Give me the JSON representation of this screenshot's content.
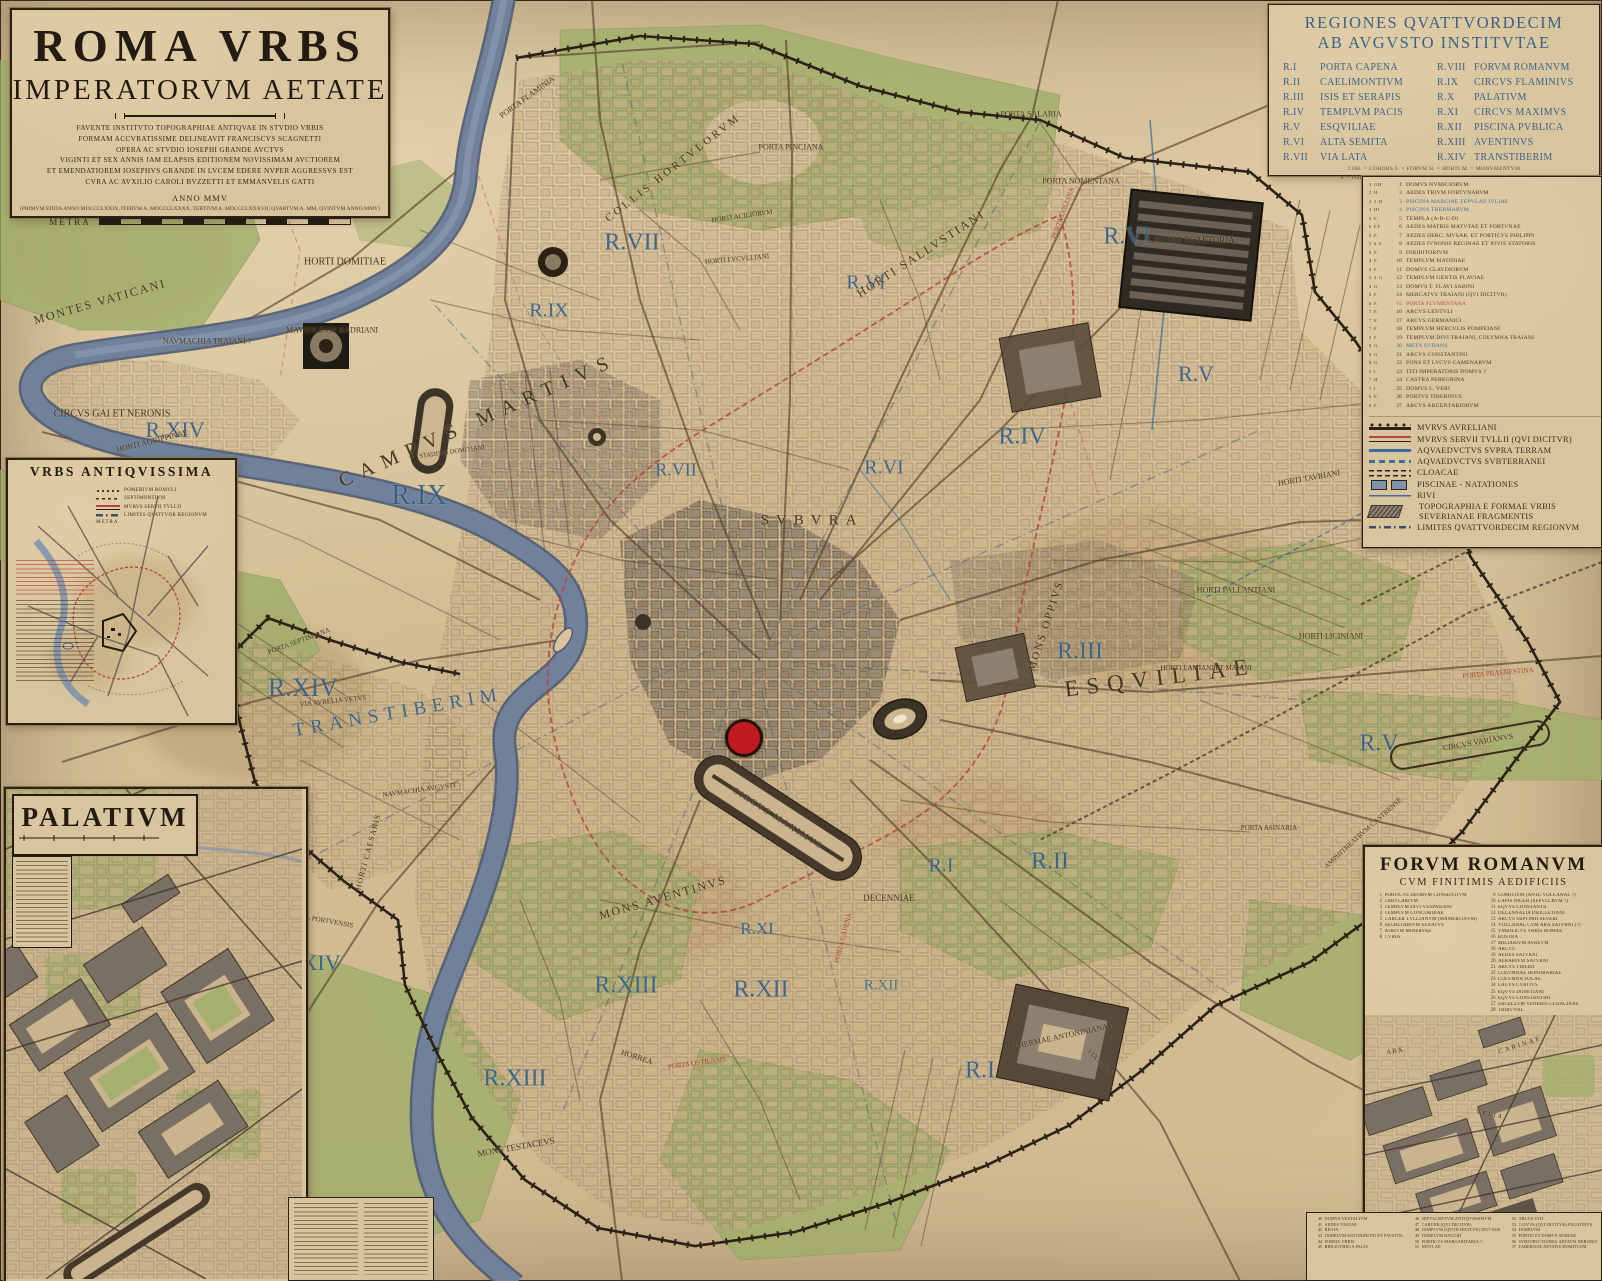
{
  "colors": {
    "accent_blue": "#33608c",
    "accent_red": "#a8372e",
    "parchment": "#d5c199",
    "river": "#71819b",
    "green": "#9fae6a",
    "wall": "#2b2115",
    "marker": "#bf1a20"
  },
  "title_panel": {
    "title1": "ROMA VRBS",
    "title2": "IMPERATORVM AETATE",
    "dedication": [
      "FAVENTE INSTITVTO TOPOGRAPHIAE ANTIQVAE IN STVDIO VRBIS",
      "FORMAM ACCVRATISSIME DELINEAVIT FRANCISCVS SCAGNETTI",
      "OPERA AC STVDIO IOSEPHI GRANDE AVCTVS",
      "VIGINTI ET SEX ANNIS IAM ELAPSIS EDITIONEM NOVISSIMAM AVCTIOREM",
      "ET EMENDATIOREM IOSEPHVS GRANDE IN LVCEM EDERE NVPER AGGRESSVS EST",
      "CVRA AC AVXILIO CAROLI BVZZETTI ET EMMANVELIS GATTI"
    ],
    "anno": "ANNO MMV",
    "editions": "(PRIMVM EDITA ANNO MDCCCLXXIX, ITERVM A. MDCCCLXXXX, TERTIVM A. MDCCCLXXXVII, QVARTVM A. MM, QVINTVM ANNO MMV)",
    "metra_label": "METRA"
  },
  "regions_panel": {
    "title_line1": "REGIONES QVATTVORDECIM",
    "title_line2": "AB AVGVSTO INSTITVTAE",
    "regions_left": [
      {
        "n": "R.I",
        "t": "PORTA CAPENA"
      },
      {
        "n": "R.II",
        "t": "CAELIMONTIVM"
      },
      {
        "n": "R.III",
        "t": "ISIS ET SERAPIS"
      },
      {
        "n": "R.IV",
        "t": "TEMPLVM PACIS"
      },
      {
        "n": "R.V",
        "t": "ESQVILIAE"
      },
      {
        "n": "R.VI",
        "t": "ALTA SEMITA"
      },
      {
        "n": "R.VII",
        "t": "VIA LATA"
      }
    ],
    "regions_right": [
      {
        "n": "R.VIII",
        "t": "FORVM ROMANVM"
      },
      {
        "n": "R.IX",
        "t": "CIRCVS FLAMINIVS"
      },
      {
        "n": "R.X",
        "t": "PALATIVM"
      },
      {
        "n": "R.XI",
        "t": "CIRCVS MAXIMVS"
      },
      {
        "n": "R.XII",
        "t": "PISCINA PVBLICA"
      },
      {
        "n": "R.XIII",
        "t": "AVENTINVS"
      },
      {
        "n": "R.XIV",
        "t": "TRANSTIBERIM"
      }
    ],
    "abbreviations": [
      "COH. = COHORS      F. = FORVM      H. = HORTI      M. = MONVMENTVM",
      "P. = PORTA      Q.D. = QVI (QVAE, QVOD) DICITVR      T.TEM. = TEMPLVM",
      "THER. = THERMAE"
    ]
  },
  "numbered_list": [
    {
      "ref": "3 GH",
      "n": 1,
      "t": "DOMVS NVMICIORVM"
    },
    {
      "ref": "2 H",
      "n": 2,
      "t": "AEDES TRIVM FORTVNARVM"
    },
    {
      "ref": "2 3 H",
      "n": 3,
      "t": "PISCINA MARCIAE TEPVLAE IVLIAE",
      "c": "blue"
    },
    {
      "ref": "3 HI",
      "n": 4,
      "t": "PISCINA THERMARVM",
      "c": "blue"
    },
    {
      "ref": "5 E",
      "n": 5,
      "t": "TEMPLA (A-B-C-D)"
    },
    {
      "ref": "6 EF",
      "n": 6,
      "t": "AEDES MATRIS MATVTAE ET FORTVNAE"
    },
    {
      "ref": "5 E",
      "n": 7,
      "t": "AEDES HERC. MVSAR. ET PORTICVS PHILIPPI"
    },
    {
      "ref": "5 6 E",
      "n": 8,
      "t": "AEDES IVNONIS REGINAE ET IOVIS STATORIS"
    },
    {
      "ref": "5 E",
      "n": 9,
      "t": "DIRIBITORIVM"
    },
    {
      "ref": "4 E",
      "n": 10,
      "t": "TEMPLVM MATIDIAE"
    },
    {
      "ref": "4 F",
      "n": 11,
      "t": "DOMVS CLAVDIORVM"
    },
    {
      "ref": "3 4 G",
      "n": 12,
      "t": "TEMPLVM GENTIS FLAVIAE"
    },
    {
      "ref": "4 G",
      "n": 13,
      "t": "DOMVS T. FLAVI SABINI"
    },
    {
      "ref": "5 F",
      "n": 14,
      "t": "MERCATVS TRAIANI (QVI DICITVR)"
    },
    {
      "ref": "6 E",
      "n": 15,
      "t": "PORTA FLVMENTANA",
      "c": "red"
    },
    {
      "ref": "7 E",
      "n": 16,
      "t": "ARCVS LENTVLI"
    },
    {
      "ref": "7 E",
      "n": 17,
      "t": "ARCVS GERMANICI"
    },
    {
      "ref": "7 F",
      "n": 18,
      "t": "TEMPLVM HERCVLIS POMPEIANI"
    },
    {
      "ref": "5 F",
      "n": 19,
      "t": "TEMPLVM DIVI TRAIANI, COLVMNA TRAIANI"
    },
    {
      "ref": "6 G",
      "n": 20,
      "t": "META SVDANS",
      "c": "blue"
    },
    {
      "ref": "6 G",
      "n": 21,
      "t": "ARCVS CONSTANTINI"
    },
    {
      "ref": "8 G",
      "n": 22,
      "t": "FONS ET LVCVS CAMENARVM"
    },
    {
      "ref": "5 I",
      "n": 23,
      "t": "TITI IMPERATORIS DOMVS ?"
    },
    {
      "ref": "7 H",
      "n": 24,
      "t": "CASTRA PEREGRINA"
    },
    {
      "ref": "7 I",
      "n": 25,
      "t": "DOMVS L. VERI"
    },
    {
      "ref": "6 E",
      "n": 26,
      "t": "PORTVS TIBERINVS"
    },
    {
      "ref": "6 F",
      "n": 27,
      "t": "ARCVS ARGENTARIORVM"
    }
  ],
  "legend": {
    "items": [
      {
        "sym": "aurelian",
        "t": "MVRVS AVRELIANI"
      },
      {
        "sym": "servian",
        "t": "MVRVS SERVII TVLLII (QVI DICITVR)"
      },
      {
        "sym": "aqua",
        "t": "AQVAEDVCTVS SVPRA TERRAM"
      },
      {
        "sym": "aquasub",
        "t": "AQVAEDVCTVS SVBTERRANEI"
      },
      {
        "sym": "cloacae",
        "t": "CLOACAE"
      },
      {
        "sym": "piscinae",
        "t": "PISCINAE - NATATIONES"
      },
      {
        "sym": "rivi",
        "t": "RIVI"
      },
      {
        "sym": "forma",
        "t": "TOPOGRAPHIA E FORMAE VRBIS SEVERIANAE FRAGMENTIS"
      },
      {
        "sym": "limites",
        "t": "LIMITES QVATTVORDECIM REGIONVM"
      }
    ]
  },
  "urbs_inset": {
    "title": "VRBS ANTIQVISSIMA",
    "legend": [
      {
        "sym": "pomerium",
        "t": "POMERIVM ROMVLI"
      },
      {
        "sym": "septi",
        "t": "SEPTIMONTIVM"
      },
      {
        "sym": "servian",
        "t": "MVRVS SERVII TVLLII"
      },
      {
        "sym": "limites",
        "t": "LIMITES QVATTVOR REGIONVM"
      }
    ],
    "metra_label": "METRA"
  },
  "palatium_inset": {
    "title": "PALATIVM"
  },
  "forum_panel": {
    "title": "FORVM ROMANVM",
    "subtitle": "CVM FINITIMIS AEDIFICIIS",
    "list_left": [
      {
        "n": 1,
        "t": "PORTICVS DEORVM CONSENTIVM"
      },
      {
        "n": 2,
        "t": "TABVLARIVM"
      },
      {
        "n": 3,
        "t": "TEMPLVM DIVI VESPASIANI"
      },
      {
        "n": 4,
        "t": "TEMPLVM CONCORDIAE"
      },
      {
        "n": 5,
        "t": "CARCER TVLLIANVM (MAMERTINVM)"
      },
      {
        "n": 6,
        "t": "SECRETARIVM SENATVS"
      },
      {
        "n": 7,
        "t": "ATRIVM MINERVAE"
      },
      {
        "n": 8,
        "t": "CVRIA"
      }
    ],
    "list_right": [
      {
        "n": 9,
        "t": "COMITIVM (ANTE VOLCANAL ?)"
      },
      {
        "n": 10,
        "t": "LAPIS NIGER (SEPVLCRVM ?)"
      },
      {
        "n": 11,
        "t": "EQVVS CONSTANTII"
      },
      {
        "n": 12,
        "t": "DECENNALIA DIOCLETIANI"
      },
      {
        "n": 13,
        "t": "ARCVS SEPTIMII SEVERI"
      },
      {
        "n": 14,
        "t": "VOLCANAL CVM ARA SATVRNI (?)"
      },
      {
        "n": 15,
        "t": "VMBILICVS VRBIS ROMAE"
      },
      {
        "n": 16,
        "t": "ROSTRA"
      },
      {
        "n": 17,
        "t": "MILIARIVM AVREVM"
      },
      {
        "n": 18,
        "t": "ARCVS"
      },
      {
        "n": 19,
        "t": "AEDES SATVRNI"
      },
      {
        "n": 20,
        "t": "AERARIVM SATVRNI"
      },
      {
        "n": 21,
        "t": "ARCVS TIBERII"
      },
      {
        "n": 22,
        "t": "COLVMNAE HONORARIAE"
      },
      {
        "n": 23,
        "t": "COLVMNA FOCAE"
      },
      {
        "n": 24,
        "t": "LACVS CVRTIVS"
      },
      {
        "n": 25,
        "t": "EQVVS DOMITIANI"
      },
      {
        "n": 26,
        "t": "EQVVS CONSTANTINI"
      },
      {
        "n": 27,
        "t": "SACELLVM VENERIS CLOACINAE"
      },
      {
        "n": 28,
        "t": "TRIBVNAL"
      }
    ],
    "bottom_col1": [
      {
        "n": 40,
        "t": "DOMVS VESTALIVM"
      },
      {
        "n": 41,
        "t": "AEDES VESTAE"
      },
      {
        "n": 42,
        "t": "REGIA"
      },
      {
        "n": 43,
        "t": "TEMPLVM ANTONINI PII ET FAVSTINAE"
      },
      {
        "n": 44,
        "t": "FORMA VRBIS"
      },
      {
        "n": 45,
        "t": "BIBLIOTHECA PACIS"
      }
    ],
    "bottom_col2": [
      {
        "n": 46,
        "t": "SEPVLCRETVM ANTIQVISSIMVM"
      },
      {
        "n": 47,
        "t": "CARCER (QVI DICITVR)"
      },
      {
        "n": 48,
        "t": "TEMPLVM (QVOD DICITVR) DIVI ROMVLI"
      },
      {
        "n": 49,
        "t": "TEMPLVM BACCHI"
      },
      {
        "n": 50,
        "t": "PORTICVS MARGARITARIA ?"
      },
      {
        "n": 51,
        "t": "INSVLAE"
      }
    ],
    "bottom_col3": [
      {
        "n": 52,
        "t": "ARCVS TITI"
      },
      {
        "n": 53,
        "t": "CLIVVS (QVI DICITVR) PALATINVS"
      },
      {
        "n": 54,
        "t": "TEMPLVM"
      },
      {
        "n": 55,
        "t": "PORTICVS DOMVS AVREAE"
      },
      {
        "n": 56,
        "t": "SVBSTRVCTIONES AETATIS NERONIANAE"
      },
      {
        "n": 57,
        "t": "TABERNAE AETATIS DOMITIANI"
      }
    ],
    "map_labels": [
      {
        "t": "ARX",
        "x": 30,
        "y": 36,
        "s": 7,
        "c": "dark",
        "r": -10,
        "ls": 1
      },
      {
        "t": "CARINAE",
        "x": 155,
        "y": 30,
        "s": 7,
        "c": "dark",
        "r": -18,
        "ls": 2
      },
      {
        "t": "VELIA",
        "x": 125,
        "y": 100,
        "s": 6,
        "c": "dark",
        "r": 10,
        "ls": 2
      }
    ]
  },
  "map": {
    "marker": {
      "x": 744,
      "y": 738,
      "r": 16
    },
    "labels": [
      {
        "t": "R.VII",
        "x": 632,
        "y": 243,
        "s": 24,
        "c": "blue"
      },
      {
        "t": "R.IX",
        "x": 549,
        "y": 311,
        "s": 20,
        "c": "blue"
      },
      {
        "t": "R.IX",
        "x": 419,
        "y": 496,
        "s": 28,
        "c": "blue"
      },
      {
        "t": "R.VII",
        "x": 676,
        "y": 470,
        "s": 18,
        "c": "blue"
      },
      {
        "t": "R.VI",
        "x": 866,
        "y": 283,
        "s": 20,
        "c": "blue"
      },
      {
        "t": "R.VI",
        "x": 1127,
        "y": 237,
        "s": 24,
        "c": "blue"
      },
      {
        "t": "R.VI",
        "x": 884,
        "y": 468,
        "s": 20,
        "c": "blue"
      },
      {
        "t": "R.IV",
        "x": 1022,
        "y": 437,
        "s": 24,
        "c": "blue"
      },
      {
        "t": "R.V",
        "x": 1196,
        "y": 374,
        "s": 22,
        "c": "blue"
      },
      {
        "t": "R.V",
        "x": 1379,
        "y": 744,
        "s": 24,
        "c": "blue"
      },
      {
        "t": "R.III",
        "x": 1080,
        "y": 652,
        "s": 24,
        "c": "blue"
      },
      {
        "t": "R.II",
        "x": 1050,
        "y": 862,
        "s": 24,
        "c": "blue"
      },
      {
        "t": "R.I",
        "x": 941,
        "y": 866,
        "s": 20,
        "c": "blue"
      },
      {
        "t": "R.I",
        "x": 980,
        "y": 1071,
        "s": 24,
        "c": "blue"
      },
      {
        "t": "R.XIV",
        "x": 175,
        "y": 430,
        "s": 22,
        "c": "blue"
      },
      {
        "t": "R.XIV",
        "x": 311,
        "y": 963,
        "s": 22,
        "c": "blue"
      },
      {
        "t": "R.XIV",
        "x": 303,
        "y": 688,
        "s": 26,
        "c": "blue"
      },
      {
        "t": "TRANSTIBERIM",
        "x": 398,
        "y": 713,
        "s": 19,
        "c": "blue",
        "r": -10,
        "ls": 6
      },
      {
        "t": "R.XIII",
        "x": 626,
        "y": 986,
        "s": 24,
        "c": "blue"
      },
      {
        "t": "R.XIII",
        "x": 515,
        "y": 1079,
        "s": 24,
        "c": "blue"
      },
      {
        "t": "R.XII",
        "x": 761,
        "y": 990,
        "s": 24,
        "c": "blue"
      },
      {
        "t": "R.XI",
        "x": 757,
        "y": 929,
        "s": 17,
        "c": "blue"
      },
      {
        "t": "R.XII",
        "x": 881,
        "y": 986,
        "s": 15,
        "c": "teal"
      },
      {
        "t": "ESQVILIAE",
        "x": 1160,
        "y": 678,
        "s": 23,
        "c": "dark",
        "r": -7,
        "ls": 8
      },
      {
        "t": "MONTES VATICANI",
        "x": 100,
        "y": 302,
        "s": 12,
        "c": "dark",
        "r": -16,
        "ls": 2
      },
      {
        "t": "HORTI DOMITIAE",
        "x": 345,
        "y": 262,
        "s": 10,
        "c": "dark"
      },
      {
        "t": "NAVMACHIA TRAIANI ?",
        "x": 207,
        "y": 341,
        "s": 8,
        "c": "dark"
      },
      {
        "t": "MAVSOLEVM HADRIANI",
        "x": 332,
        "y": 330,
        "s": 8,
        "c": "dark"
      },
      {
        "t": "CIRCVS GAI ET NERONIS",
        "x": 112,
        "y": 414,
        "s": 10,
        "c": "dark"
      },
      {
        "t": "HORTI AGRIPPINAE",
        "x": 152,
        "y": 441,
        "s": 8,
        "c": "dark",
        "r": -14
      },
      {
        "t": "PORTA FLAMINIA",
        "x": 527,
        "y": 97,
        "s": 8,
        "c": "dark",
        "r": -36
      },
      {
        "t": "COLLIS HORTVLORVM",
        "x": 673,
        "y": 168,
        "s": 11,
        "c": "dark",
        "r": -38,
        "ls": 3
      },
      {
        "t": "PORTA PINCIANA",
        "x": 791,
        "y": 147,
        "s": 8,
        "c": "dark"
      },
      {
        "t": "HORTI ACILIORVM",
        "x": 742,
        "y": 216,
        "s": 7,
        "c": "dark",
        "r": -8
      },
      {
        "t": "HORTI LVCVLLIANI",
        "x": 737,
        "y": 259,
        "s": 7,
        "c": "dark",
        "r": -5
      },
      {
        "t": "PORTA SALARIA",
        "x": 1031,
        "y": 114,
        "s": 8,
        "c": "dark"
      },
      {
        "t": "PORTA NOMENTANA",
        "x": 1081,
        "y": 181,
        "s": 8,
        "c": "dark"
      },
      {
        "t": "CASTRA PRAETORIA",
        "x": 1191,
        "y": 240,
        "s": 9,
        "c": "dark"
      },
      {
        "t": "PORTA COLLINA",
        "x": 1063,
        "y": 213,
        "s": 7,
        "c": "red",
        "r": -70
      },
      {
        "t": "HORTI SALLVSTIANI",
        "x": 921,
        "y": 254,
        "s": 12,
        "c": "dark",
        "r": -33,
        "ls": 2
      },
      {
        "t": "CAMPVS MARTIVS",
        "x": 478,
        "y": 421,
        "s": 20,
        "c": "dark",
        "r": -24,
        "ls": 9
      },
      {
        "t": "STADIVM DOMITIANI",
        "x": 452,
        "y": 452,
        "s": 6.5,
        "c": "dark",
        "r": -8
      },
      {
        "t": "SVBVRA",
        "x": 812,
        "y": 521,
        "s": 15,
        "c": "dark",
        "ls": 7
      },
      {
        "t": "MONS OPPIVS",
        "x": 1046,
        "y": 626,
        "s": 11,
        "c": "dark",
        "r": -72,
        "ls": 2
      },
      {
        "t": "HORTI PALLANTIANI",
        "x": 1236,
        "y": 590,
        "s": 8,
        "c": "dark"
      },
      {
        "t": "HORTI LICINIANI",
        "x": 1331,
        "y": 636,
        "s": 8,
        "c": "dark"
      },
      {
        "t": "HORTI LAMIANI ET MAIANI",
        "x": 1206,
        "y": 668,
        "s": 7,
        "c": "dark"
      },
      {
        "t": "HORTI TAVRIANI",
        "x": 1309,
        "y": 478,
        "s": 8,
        "c": "dark",
        "r": -10
      },
      {
        "t": "MONS AVENTINVS",
        "x": 663,
        "y": 898,
        "s": 12,
        "c": "dark",
        "r": -16,
        "ls": 2
      },
      {
        "t": "MONS TESTACEVS",
        "x": 516,
        "y": 1147,
        "s": 9,
        "c": "dark",
        "r": -10
      },
      {
        "t": "HORREA",
        "x": 637,
        "y": 1057,
        "s": 8,
        "c": "dark",
        "r": 18
      },
      {
        "t": "THERMAE ANTONINIANAE",
        "x": 1063,
        "y": 1036,
        "s": 8,
        "c": "dark",
        "r": -12
      },
      {
        "t": "DECENNIAE",
        "x": 889,
        "y": 898,
        "s": 9,
        "c": "dark"
      },
      {
        "t": "CIRCVS MAXIMVS",
        "x": 778,
        "y": 818,
        "s": 9,
        "c": "dark",
        "r": 33,
        "ls": 2
      },
      {
        "t": "AMPHITHEATRVM CASTRENSE",
        "x": 1363,
        "y": 833,
        "s": 7,
        "c": "dark",
        "r": -42
      },
      {
        "t": "CIRCVS VARIANVS",
        "x": 1478,
        "y": 742,
        "s": 8,
        "c": "dark",
        "r": -10
      },
      {
        "t": "PORTA ASINARIA",
        "x": 1269,
        "y": 828,
        "s": 7,
        "c": "dark"
      },
      {
        "t": "PORTA PORTVENSIS",
        "x": 321,
        "y": 920,
        "s": 7,
        "c": "dark",
        "r": 10
      },
      {
        "t": "PORTA OSTIENSIS",
        "x": 697,
        "y": 1063,
        "s": 7,
        "c": "red",
        "r": -8
      },
      {
        "t": "VIA AVRELIA VETVS",
        "x": 333,
        "y": 701,
        "s": 7,
        "c": "dark",
        "r": -6
      },
      {
        "t": "NAVMACHIA AVGVSTI",
        "x": 419,
        "y": 790,
        "s": 7,
        "c": "dark",
        "r": -8
      },
      {
        "t": "PORTA SEPTIMIANA",
        "x": 299,
        "y": 641,
        "s": 7,
        "c": "dark",
        "r": -20
      },
      {
        "t": "PORTA PRAENESTINA",
        "x": 1498,
        "y": 673,
        "s": 7,
        "c": "red",
        "r": -5
      },
      {
        "t": "PORTA TIBVRTINA",
        "x": 1441,
        "y": 518,
        "s": 7,
        "c": "red",
        "r": -12
      },
      {
        "t": "PORTA CAPENA",
        "x": 843,
        "y": 938,
        "s": 7,
        "c": "red",
        "r": -75
      },
      {
        "t": "VIA APPIA",
        "x": 1100,
        "y": 1062,
        "s": 7,
        "c": "dark",
        "r": 45
      },
      {
        "t": "HORTI CAESARIS",
        "x": 368,
        "y": 852,
        "s": 8,
        "c": "dark",
        "r": -75,
        "ls": 1
      }
    ]
  }
}
